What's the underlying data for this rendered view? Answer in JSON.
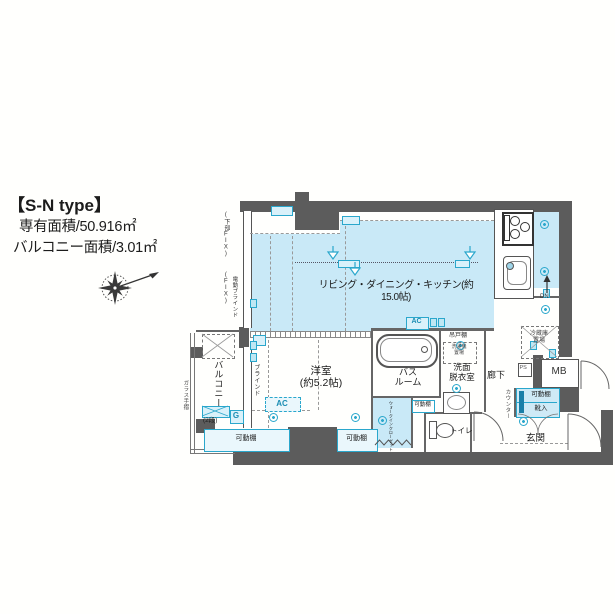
{
  "header": {
    "title": "【S-N type】",
    "area1": "専有面積/50.916㎡",
    "area2": "バルコニー面積/3.01㎡"
  },
  "rooms": {
    "ldk": "リビング・ダイニング・キッチン(約15.0帖)",
    "bedroom": "洋室\n(約5.2帖)",
    "bathroom": "バス\nルーム",
    "washroom": "洗面\n脱衣室",
    "corridor": "廊下",
    "toilet": "トイレ",
    "entrance": "玄関",
    "balcony": "バルコニー",
    "wic": "ウォークインクローゼット"
  },
  "labels": {
    "shelf": "可動棚",
    "ac": "AC",
    "hanging_cupboard": "吊戸棚",
    "washer": "洗濯機\n置場",
    "fridge": "冷蔵庫\n置場",
    "mb": "MB",
    "ps": "PS",
    "dn": "DN",
    "g": "G",
    "two_tier": "(2段)",
    "counter": "カウンター",
    "shoes": "靴入",
    "glass_rail": "ガラス手摺",
    "fix_lower": "(下部FIX)",
    "fix": "(FIX)",
    "electric_blind": "電動ブラインド",
    "blind": "ブラインド"
  },
  "colors": {
    "wall": "#5c5c5c",
    "room_fill": "#c9e9f7",
    "accent": "#2aa7cc"
  }
}
